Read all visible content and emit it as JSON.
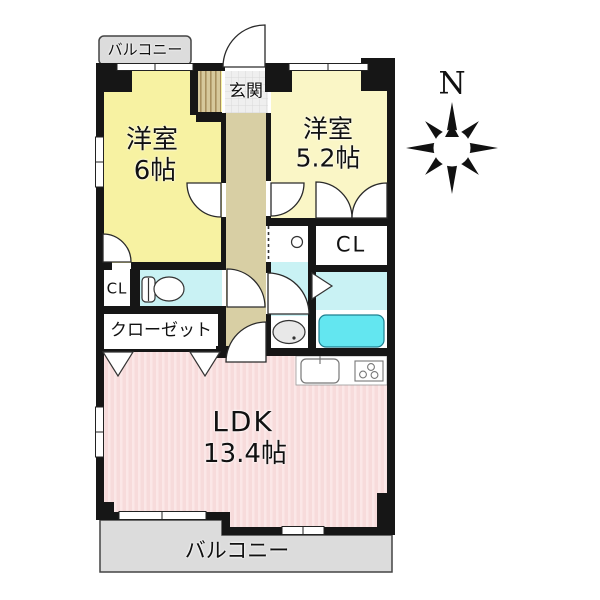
{
  "plan_title": "1LDK apartment floor plan",
  "compass": {
    "north_label": "N"
  },
  "balconies": {
    "top_label": "バルコニー",
    "bottom_label": "バルコニー"
  },
  "entrance": {
    "label": "玄関"
  },
  "rooms": {
    "bedroom6": {
      "name": "洋室",
      "area": "6帖"
    },
    "bedroom52": {
      "name": "洋室",
      "area": "5.2帖"
    },
    "ldk": {
      "name": "LDK",
      "area": "13.4帖"
    },
    "closet_small_left": {
      "label": "CL"
    },
    "closet_small_right": {
      "label": "CL"
    },
    "closet_main": {
      "label": "クローゼット"
    }
  },
  "colors": {
    "wall": "#161616",
    "bedroom6_fill": "#F7F2A2",
    "bedroom52_fill": "#FAF6C6",
    "corridor_fill": "#D8CFA4",
    "entrance_tile_fill": "#EFEFEF",
    "wet_room_fill": "#C9F2F4",
    "bathtub_fill": "#63E6F0",
    "ldk_fill": "#F7DBDB",
    "balcony_fill": "#DCDCDC"
  }
}
